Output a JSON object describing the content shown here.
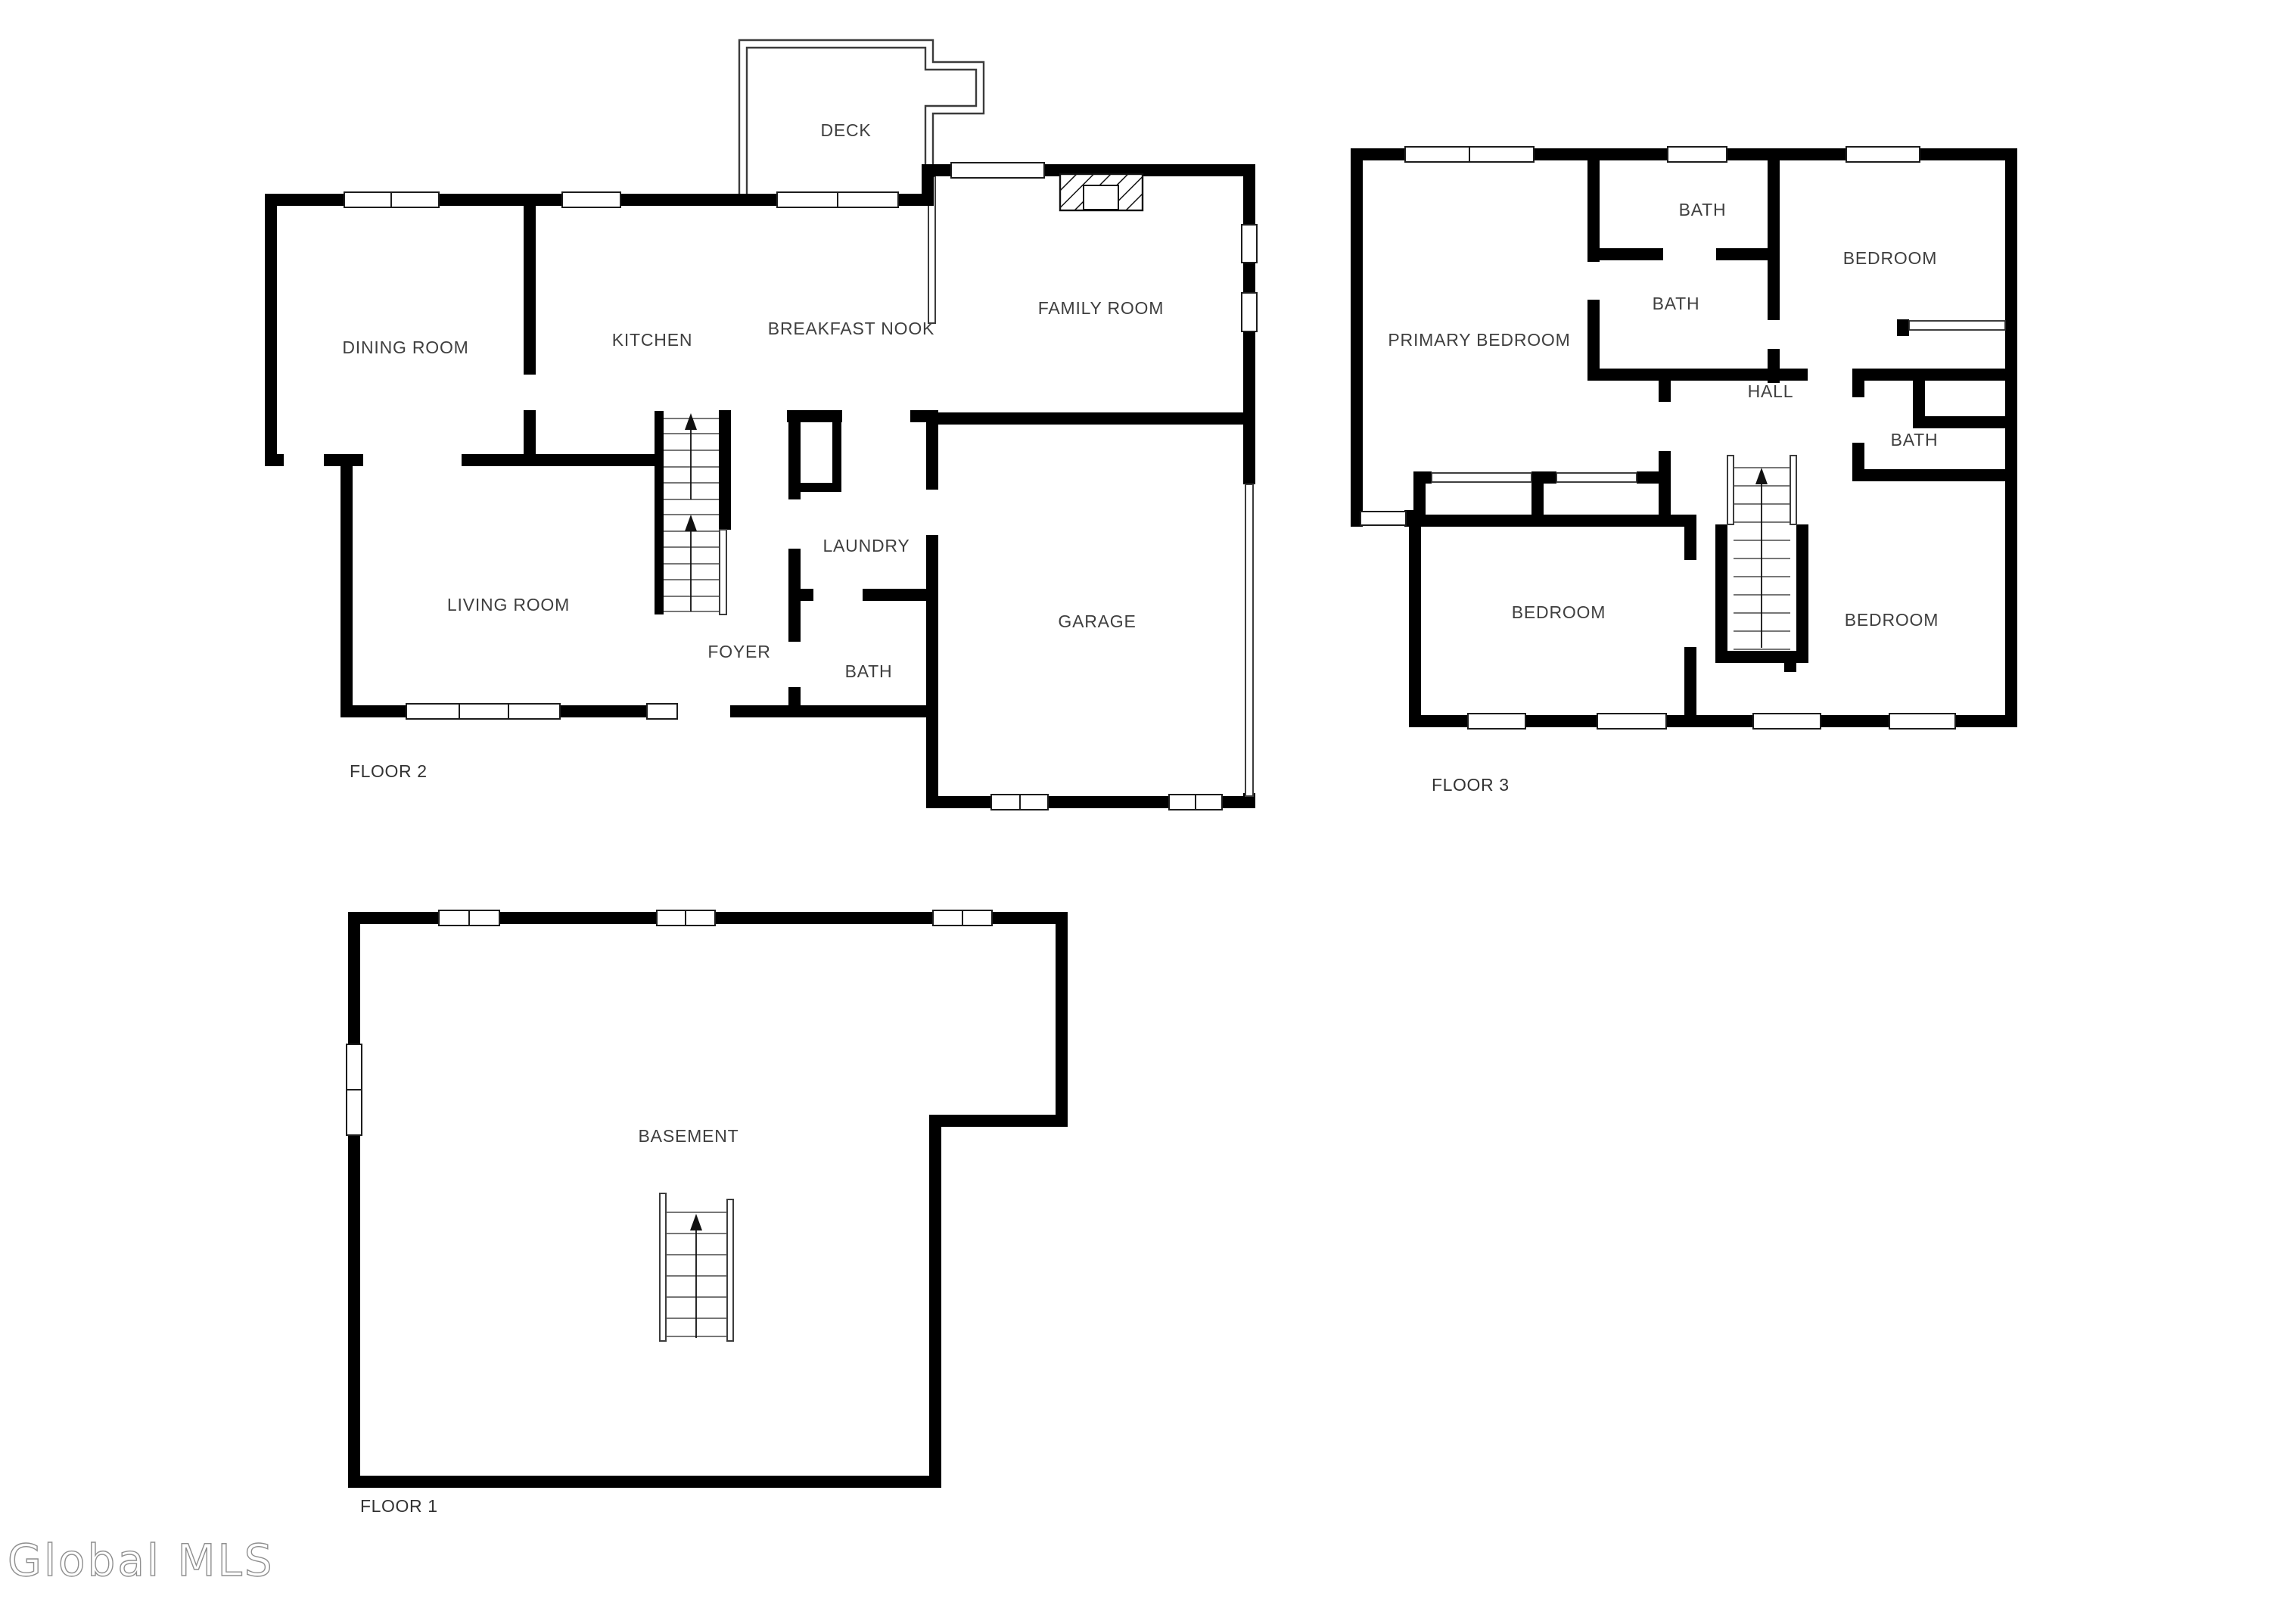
{
  "watermark": {
    "text": "Global MLS"
  },
  "floors": [
    {
      "id": "floor-2",
      "label": "FLOOR 2",
      "rooms": [
        {
          "name": "dining-room",
          "label": "DINING ROOM"
        },
        {
          "name": "kitchen",
          "label": "KITCHEN"
        },
        {
          "name": "breakfast-nook",
          "label": "BREAKFAST NOOK"
        },
        {
          "name": "deck",
          "label": "DECK"
        },
        {
          "name": "family-room",
          "label": "FAMILY ROOM"
        },
        {
          "name": "living-room",
          "label": "LIVING ROOM"
        },
        {
          "name": "foyer",
          "label": "FOYER"
        },
        {
          "name": "laundry",
          "label": "LAUNDRY"
        },
        {
          "name": "bath",
          "label": "BATH"
        },
        {
          "name": "garage",
          "label": "GARAGE"
        }
      ]
    },
    {
      "id": "floor-3",
      "label": "FLOOR 3",
      "rooms": [
        {
          "name": "primary-bedroom",
          "label": "PRIMARY BEDROOM"
        },
        {
          "name": "bath-top",
          "label": "BATH"
        },
        {
          "name": "bath-middle",
          "label": "BATH"
        },
        {
          "name": "bedroom-top-right",
          "label": "BEDROOM"
        },
        {
          "name": "hall",
          "label": "HALL"
        },
        {
          "name": "bath-right",
          "label": "BATH"
        },
        {
          "name": "bedroom-bottom-left",
          "label": "BEDROOM"
        },
        {
          "name": "bedroom-bottom-right",
          "label": "BEDROOM"
        }
      ]
    },
    {
      "id": "floor-1",
      "label": "FLOOR 1",
      "rooms": [
        {
          "name": "basement",
          "label": "BASEMENT"
        }
      ]
    }
  ]
}
